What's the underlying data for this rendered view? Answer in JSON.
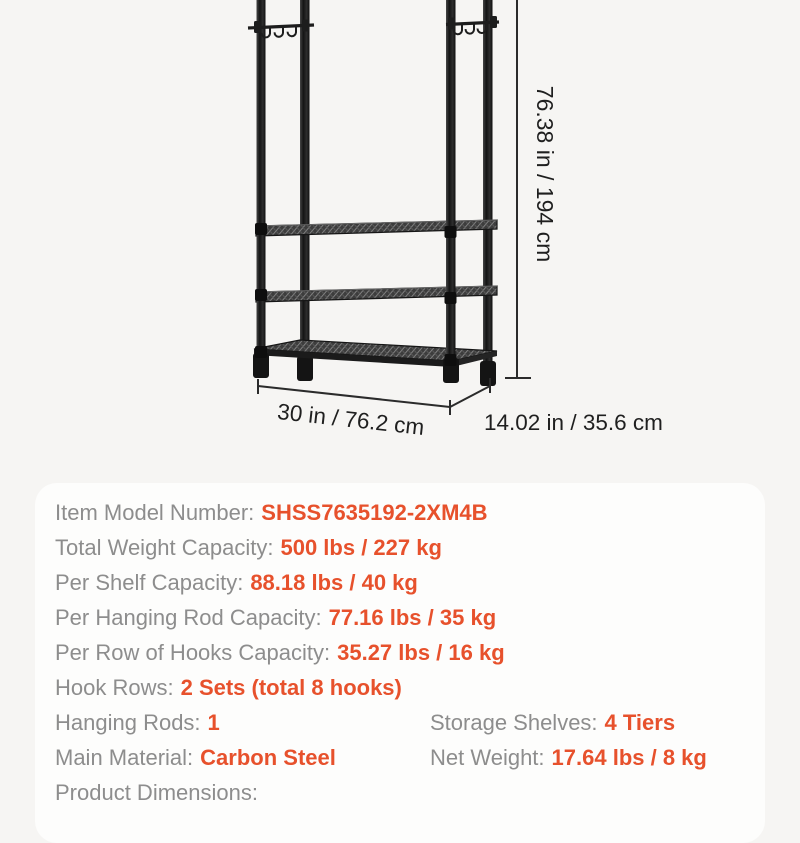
{
  "page": {
    "background_color": "#F6F5F3"
  },
  "product_figure": {
    "description": "black metal garment rack with two hook rows and 4-tier wire shelves shown with dimension lines",
    "dimension_labels": {
      "height": "76.38 in / 194 cm",
      "width": "30 in / 76.2 cm",
      "depth": "14.02 in / 35.6 cm"
    },
    "colors": {
      "rack": "#1C1C1C",
      "dimension_lines": "#2B2B2B",
      "dimension_text": "#1F1F1F"
    }
  },
  "spec_card": {
    "background_color": "#FDFDFC",
    "label_color": "#8D8D8D",
    "value_color": "#E7512C",
    "rows": [
      {
        "label": "Item Model Number:",
        "value": "SHSS7635192-2XM4B"
      },
      {
        "label": "Total Weight Capacity:",
        "value": "500 lbs / 227 kg"
      },
      {
        "label": "Per Shelf Capacity:",
        "value": "88.18 lbs / 40 kg"
      },
      {
        "label": "Per Hanging Rod Capacity:",
        "value": "77.16 lbs / 35 kg"
      },
      {
        "label": "Per Row of Hooks Capacity:",
        "value": "35.27 lbs / 16 kg"
      },
      {
        "label": "Hook Rows:",
        "value": "2 Sets (total 8 hooks)"
      }
    ],
    "dual_rows": [
      {
        "left": {
          "label": "Hanging Rods:",
          "value": "1"
        },
        "right": {
          "label": "Storage Shelves:",
          "value": "4 Tiers"
        }
      },
      {
        "left": {
          "label": "Main Material:",
          "value": "Carbon Steel"
        },
        "right": {
          "label": "Net Weight:",
          "value": "17.64 lbs / 8 kg"
        }
      }
    ],
    "trailing_row": {
      "label": "Product Dimensions:",
      "value": ""
    }
  }
}
